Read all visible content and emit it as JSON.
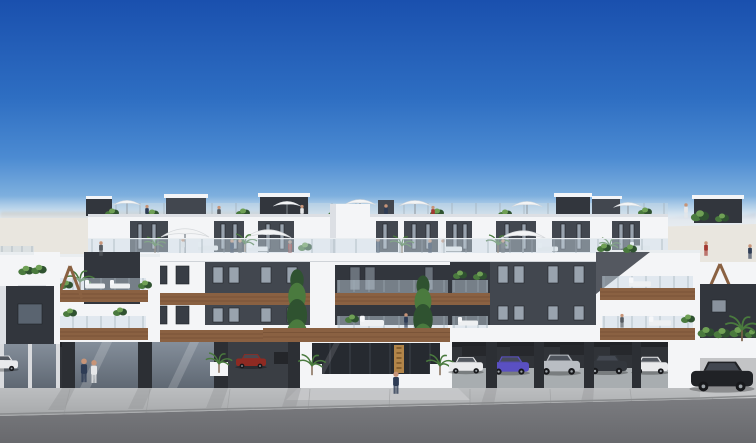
{
  "title": "Architectural render: modern white apartment complex, street elevation on a clear sunny day",
  "scene": {
    "sky": "clear blue gradient, deep blue at top fading to pale haze at horizon",
    "horizon_left": "blurred distant treeline over pale sand plain",
    "horizon_right": "distant blue mountain ridge",
    "street": "dark asphalt road with light concrete sidewalk in front of building"
  },
  "building": {
    "style": "contemporary white render with anthracite feature panels",
    "levels": [
      "ground floor: glazed commercial units, central glass entrance lobby and open parking garage",
      "two apartment floors with timber-fascia balconies and frameless glass railings",
      "set-back penthouse level with large shared roof terrace",
      "top roof deck with plant pots, parasols and dark pergola/stair boxes"
    ],
    "balcony_fascia": "timber",
    "railings": "frameless glass",
    "decor": "X-shaped timber feature trellises on both end volumes"
  },
  "entrance": {
    "glazed_lobby": true,
    "sign": "vertical bronze sign beside the door",
    "planters": "white planters with palms on both sides"
  },
  "vehicles": {
    "garage_cars": [
      "white",
      "purple",
      "silver",
      "dark gray",
      "white",
      "red"
    ],
    "street_cars": [
      "black coupe at right",
      "white hatchback at far left"
    ]
  },
  "roof": {
    "parasols_small": 6,
    "parasols_large": 3,
    "plants": "potted shrubs, palms and two tall cypress trees on the central balconies"
  },
  "people_visible": 22,
  "palette": {
    "sky_top": "#1a50ae",
    "sky_mid": "#2e6ec2",
    "sky_mid2": "#4c8bd2",
    "sky_low": "#8fbce2",
    "sky_horizon": "#d8e6f0",
    "horizon_haze": "#edf1f4",
    "treeline": "#8f897a",
    "mountains": "#7e93b4",
    "mountains_far": "#a9b9cf",
    "sand": "#e9e6df",
    "wall_white": "#f4f5f7",
    "wall_shade": "#dcdfe4",
    "facade_dark": "#42474f",
    "facade_darker": "#32363d",
    "window_glass": "#99a3ae",
    "window_dark": "#383d45",
    "window_frame": "#202328",
    "wood": "#8a6142",
    "wood_dark": "#6d4a30",
    "glass_rail": "#c9d9e4",
    "rail_post": "#9fabb4",
    "umbrella": "#f3f4f5",
    "pillar": "#2c2f34",
    "storefront_top": "#848e9a",
    "storefront_bottom": "#5f6873",
    "lobby_glass": "#262a30",
    "garage_dark": "#303338",
    "garage_floor": "#b6babe",
    "gold": "#b28549",
    "sidewalk": "#bcbec0",
    "sidewalk_dark": "#a7a9ab",
    "road": "#7b7c80",
    "road_dark": "#68696d",
    "plant_dark": "#2f5230",
    "plant_mid": "#4a7a3e",
    "plant_light": "#6fa055",
    "car_purple": "#5a50c2",
    "car_silver": "#b9bdc3",
    "car_dark": "#33373d",
    "car_white": "#e9eaec",
    "car_red": "#8e2a22",
    "car_black": "#202226",
    "people_navy": "#2e3c55",
    "people_gray": "#565b62",
    "people_red": "#a23830",
    "people_white": "#e6e7e9",
    "skin": "#c79478"
  }
}
